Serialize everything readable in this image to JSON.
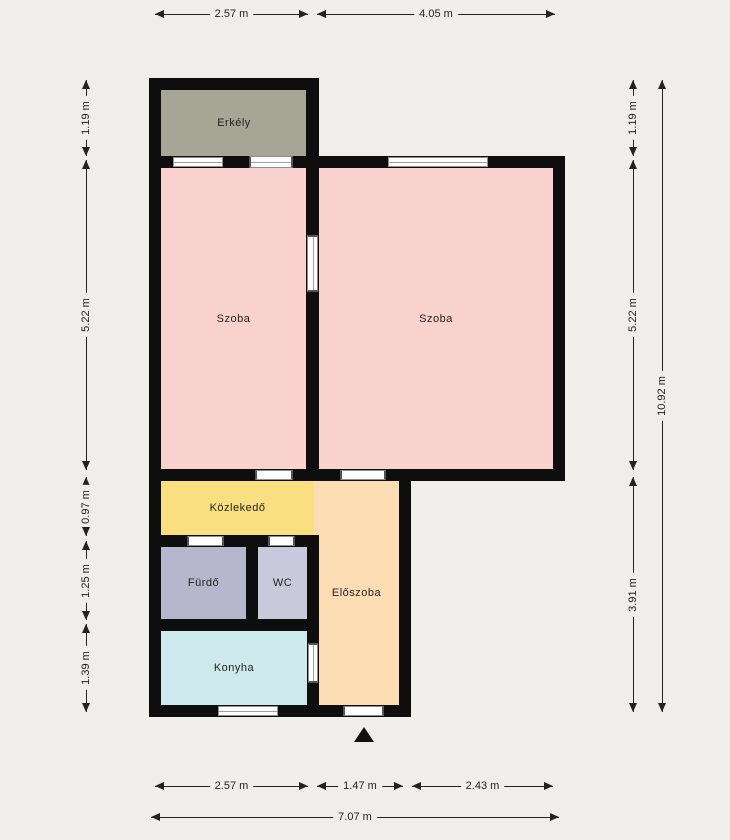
{
  "canvas": {
    "background": "#efeeea",
    "wall_color": "#0e0e0e"
  },
  "rooms": {
    "erkely": {
      "label": "Erkély",
      "color": "#a6a697"
    },
    "szoba_left": {
      "label": "Szoba",
      "color": "#fad2cd"
    },
    "szoba_right": {
      "label": "Szoba",
      "color": "#fad2cd"
    },
    "kozlekedo": {
      "label": "Közlekedő",
      "color": "#fadf80"
    },
    "furdo": {
      "label": "Fürdő",
      "color": "#b6b6cc"
    },
    "wc": {
      "label": "WC",
      "color": "#c9c9db"
    },
    "eloszoba": {
      "label": "Előszoba",
      "color": "#fcdcb2"
    },
    "konyha": {
      "label": "Konyha",
      "color": "#cde9ed"
    }
  },
  "dimensions": {
    "top": [
      "2.57 m",
      "4.05 m"
    ],
    "left": [
      "1.19 m",
      "5.22 m",
      "0.97 m",
      "1.25 m",
      "1.39 m"
    ],
    "right": [
      "1.19 m",
      "5.22 m",
      "3.91 m"
    ],
    "right_total": "10.92 m",
    "bottom": [
      "2.57 m",
      "1.47 m",
      "2.43 m"
    ],
    "bottom_total": "7.07 m"
  }
}
